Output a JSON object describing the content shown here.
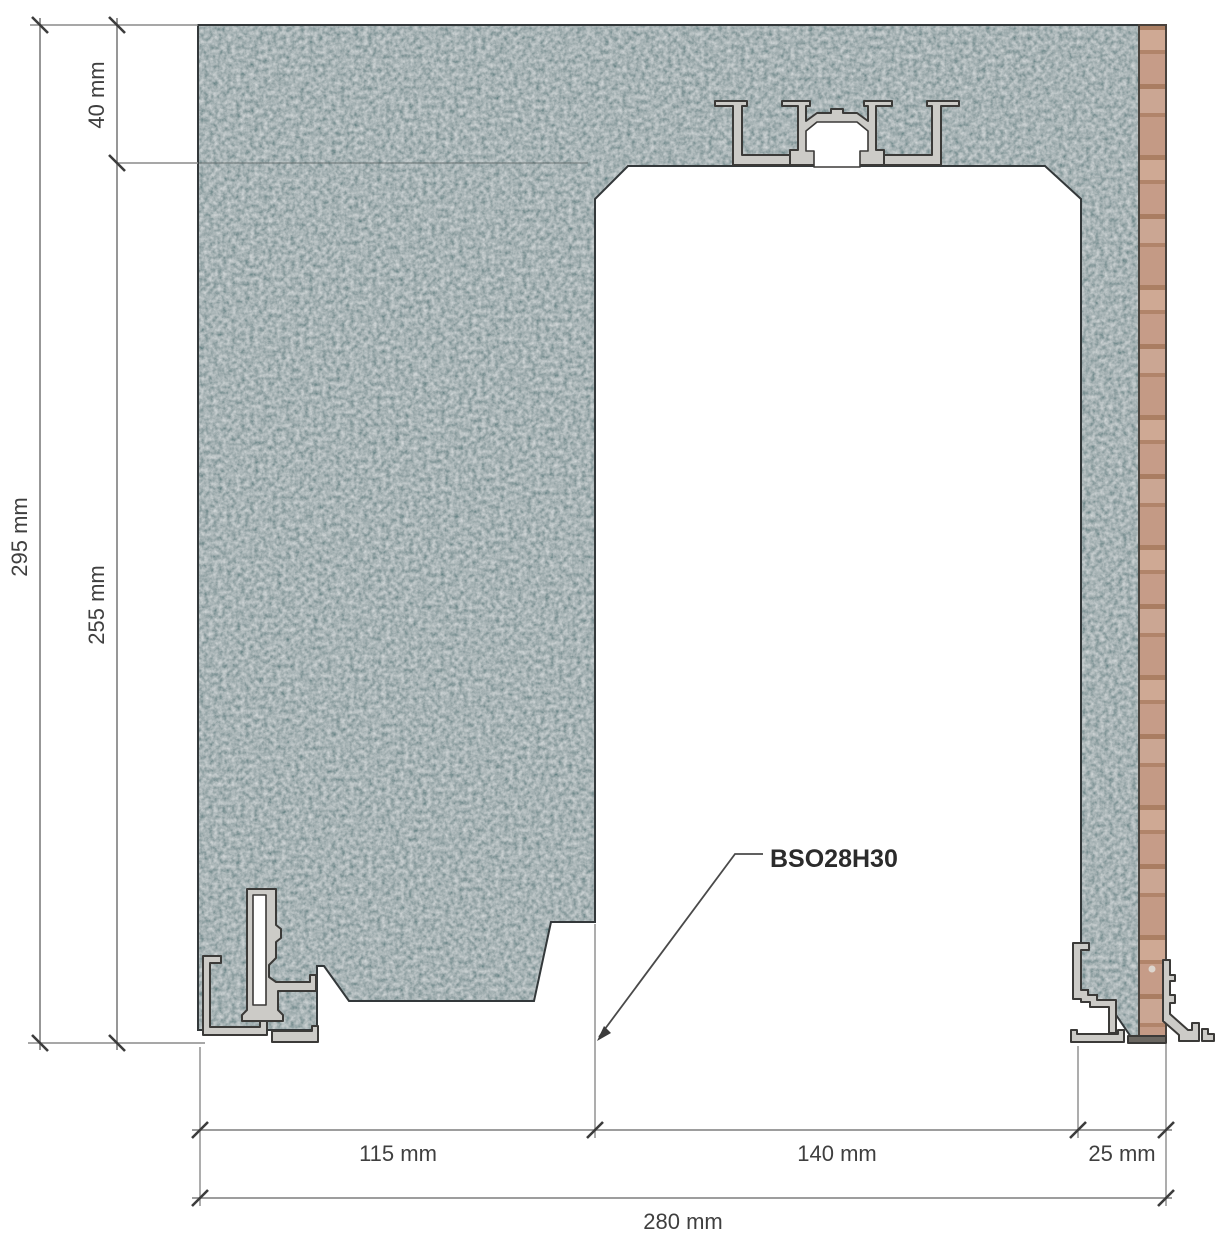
{
  "drawing": {
    "type": "construction-section-detail",
    "product_label": "BSO28H30",
    "dimensions": {
      "overall_height": "295 mm",
      "lintel_height": "40 mm",
      "opening_height": "255 mm",
      "left_jamb_width": "115 mm",
      "opening_width": "140 mm",
      "panel_thickness": "25 mm",
      "overall_width": "280 mm"
    },
    "colors": {
      "insulation_base": "#5f7173",
      "wood_base": "#c9a08c",
      "aluminum": "#cccbc7",
      "outline": "#3b3a38",
      "dimension_line": "#7d7d7d",
      "label_text": "#3f3f3f"
    }
  }
}
